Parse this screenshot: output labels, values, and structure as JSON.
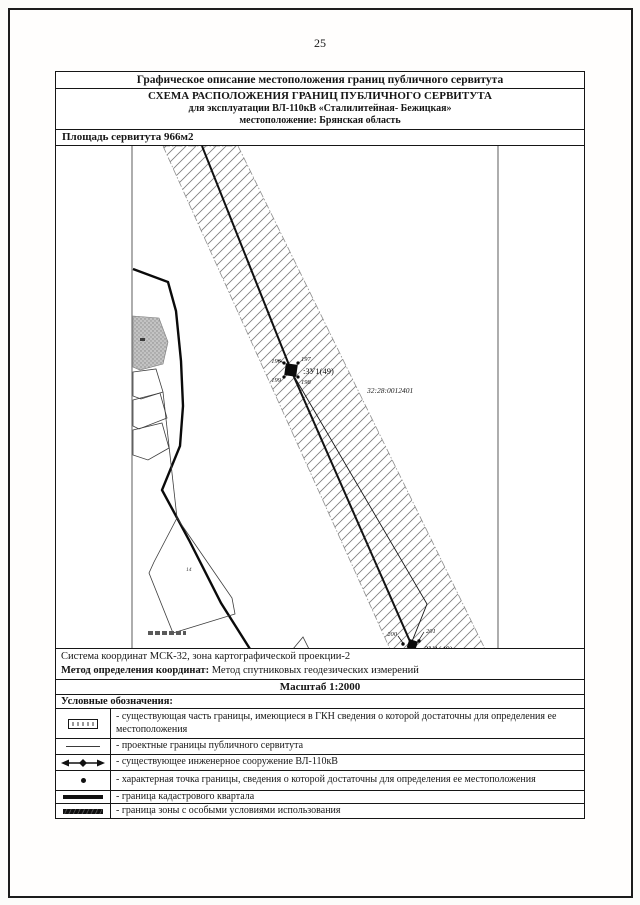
{
  "page": {
    "number": "25"
  },
  "header": {
    "title": "Графическое описание местоположения границ публичного сервитута",
    "scheme_title": "СХЕМА РАСПОЛОЖЕНИЯ ГРАНИЦ ПУБЛИЧНОГО СЕРВИТУТА",
    "scheme_subtitle": "для эксплуатации ВЛ-110кВ «Сталилитейная- Бежицкая»",
    "scheme_location": "местоположение: Брянская область",
    "area_label": "Площадь сервитута  966м2"
  },
  "map": {
    "cadastral_quarter": "32:28:0012401",
    "parcel_label_upper": ":ЗУ1(49)",
    "parcel_label_lower": ":ЗУ1(49)",
    "points_upper": [
      "196",
      "197",
      "199",
      "198"
    ],
    "points_lower": [
      "200",
      "201"
    ],
    "small_parcel_label": "14"
  },
  "footer": {
    "coord_system": "Система координат МСК-32, зона картографической проекции-2",
    "method_label": "Метод определения координат:",
    "method_value": " Метод спутниковых геодезических измерений",
    "scale": "Масштаб 1:2000",
    "legend_title": "Условные обозначения:"
  },
  "legend": [
    {
      "symbol": "existing-boundary-box",
      "text": "- существующая часть границы, имеющиеся в ГКН сведения о которой достаточны для определения ее местоположения"
    },
    {
      "symbol": "thin-line",
      "text": "- проектные границы публичного сервитута"
    },
    {
      "symbol": "power-line-arrows",
      "text": "- существующее инженерное сооружение ВЛ-110кВ"
    },
    {
      "symbol": "point-dot",
      "text": "- характерная точка границы, сведения о которой достаточны для определения ее местоположения"
    },
    {
      "symbol": "thick-line",
      "text": "- граница кадастрового квартала"
    },
    {
      "symbol": "zone-line",
      "text": "- граница зоны с особыми условиями использования"
    }
  ]
}
